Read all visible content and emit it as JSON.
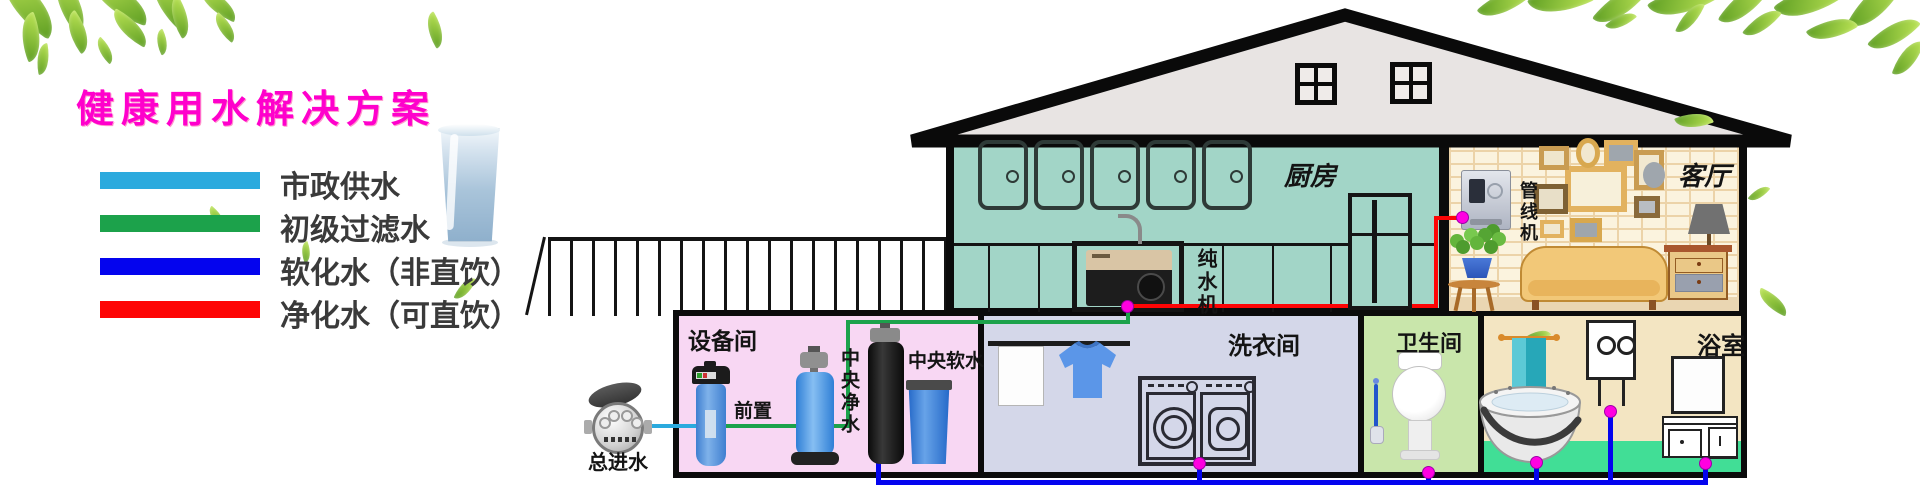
{
  "header": {
    "title": "健康用水解决方案",
    "title_color": "#FF00CC"
  },
  "legend": {
    "items": [
      {
        "label": "市政供水",
        "color": "#2BAADE"
      },
      {
        "label": "初级过滤水",
        "color": "#1CA24B"
      },
      {
        "label": "软化水（非直饮）",
        "color": "#0404EE"
      },
      {
        "label": "净化水（可直饮）",
        "color": "#FE0505"
      }
    ]
  },
  "supply": {
    "meter_label": "总进水"
  },
  "house": {
    "kitchen": {
      "label": "厨房",
      "purifier_label": "纯水机"
    },
    "living_room": {
      "label": "客厅",
      "dispenser_label": "管线机"
    },
    "equipment_room": {
      "label": "设备间",
      "prefilter_label": "前置",
      "central_purifier_label": "中央净水",
      "central_softener_label": "中央软水"
    },
    "laundry_room": {
      "label": "洗衣间"
    },
    "toilet_room": {
      "label": "卫生间"
    },
    "bathroom": {
      "label": "浴室"
    }
  }
}
